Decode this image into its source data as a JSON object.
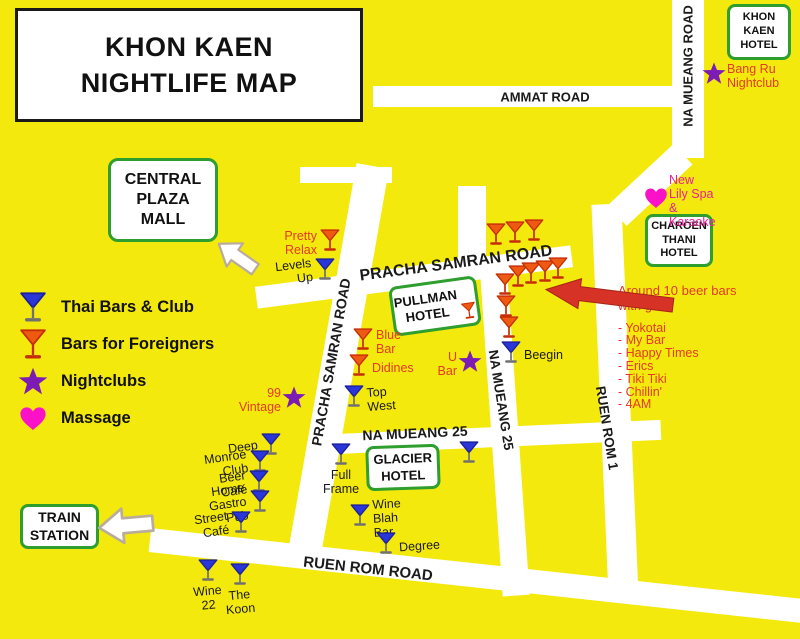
{
  "title": {
    "line1_2": "KHON KAEN\nNIGHTLIFE MAP"
  },
  "colors": {
    "background": "#F4E90C",
    "road": "#FFFFFF",
    "green_border": "#2E9E2E",
    "red_label": "#E23A26",
    "magenta_label": "#EF1D9A",
    "purple_star": "#7D1BB5",
    "blue_martini": "#2B36D9",
    "red_martini": "#EE5A11",
    "heart_pink": "#FB12C8",
    "black_text": "#1A1A1A",
    "arrow_red": "#D63226",
    "arrow_white": "#FFFFFF"
  },
  "legend": {
    "items": [
      {
        "icon": "martini-blue-icon",
        "label": "Thai Bars & Club"
      },
      {
        "icon": "martini-red-icon",
        "label": "Bars for Foreigners"
      },
      {
        "icon": "star-icon",
        "label": "Nightclubs"
      },
      {
        "icon": "heart-icon",
        "label": "Massage"
      }
    ]
  },
  "roads": [
    {
      "id": "ammat-road",
      "x": 373,
      "y": 86,
      "w": 331,
      "h": 21,
      "rot": 0
    },
    {
      "id": "na-mueang-road-upper",
      "x": 672,
      "y": 0,
      "w": 32,
      "h": 158,
      "rot": 0
    },
    {
      "id": "na-mueang-road-bend",
      "x": 636,
      "y": 140,
      "w": 28,
      "h": 90,
      "rot": 47
    },
    {
      "id": "ruen-rom-1-road",
      "x": 600,
      "y": 204,
      "w": 30,
      "h": 392,
      "rot": -2.5
    },
    {
      "id": "pracha-samran-road-horizontal",
      "x": 255,
      "y": 266,
      "w": 318,
      "h": 22,
      "rot": -7.5
    },
    {
      "id": "pracha-samran-road-vertical",
      "x": 321.5,
      "y": 162.5,
      "w": 33,
      "h": 395,
      "rot": 10
    },
    {
      "id": "pracha-samran-top-stub",
      "x": 300,
      "y": 167,
      "w": 92,
      "h": 16,
      "rot": 0
    },
    {
      "id": "na-mueang-25-top-stub",
      "x": 458,
      "y": 186,
      "w": 28,
      "h": 88,
      "rot": 0
    },
    {
      "id": "na-mueang-25-road-vertical",
      "x": 490.5,
      "y": 260,
      "w": 27,
      "h": 336,
      "rot": -4
    },
    {
      "id": "na-mueang-25-road-horizontal",
      "x": 333,
      "y": 427,
      "w": 328,
      "h": 20,
      "rot": -2.5
    },
    {
      "id": "ruen-rom-road",
      "x": 147.5,
      "y": 564,
      "w": 665,
      "h": 24,
      "rot": 6.2
    }
  ],
  "road_labels": [
    {
      "text": "AMMAT ROAD",
      "x": 545,
      "y": 97,
      "rot": 0,
      "size": 13
    },
    {
      "text": "NA MUEANG ROAD",
      "x": 688,
      "y": 66,
      "rot": -90,
      "size": 13
    },
    {
      "text": "PRACHA SAMRAN ROAD",
      "x": 456,
      "y": 264,
      "rot": -7.5,
      "size": 16
    },
    {
      "text": "PRACHA SAMRAN ROAD",
      "x": 331,
      "y": 362,
      "rot": -80,
      "size": 14
    },
    {
      "text": "NA MUEANG 25",
      "x": 415,
      "y": 433,
      "rot": -2.5,
      "size": 14
    },
    {
      "text": "NA MUEANG 25",
      "x": 501,
      "y": 400,
      "rot": 81,
      "size": 13.5
    },
    {
      "text": "RUEN ROM 1",
      "x": 607,
      "y": 428,
      "rot": 81,
      "size": 13.5
    },
    {
      "text": "RUEN ROM ROAD",
      "x": 368,
      "y": 569,
      "rot": 6.2,
      "size": 15
    }
  ],
  "places": [
    {
      "id": "khon-kaen-hotel",
      "label": "KHON\nKAEN\nHOTEL",
      "x": 727,
      "y": 4,
      "w": 64,
      "h": 56,
      "size": 11,
      "rot": 0
    },
    {
      "id": "central-plaza-mall",
      "label": "CENTRAL\nPLAZA\nMALL",
      "x": 108,
      "y": 158,
      "w": 110,
      "h": 84,
      "size": 16,
      "rot": 0
    },
    {
      "id": "charoen-thani-hotel",
      "label": "CHAROEN\nTHANI\nHOTEL",
      "x": 645,
      "y": 214,
      "w": 68,
      "h": 53,
      "size": 11,
      "rot": 0
    },
    {
      "id": "pullman-hotel",
      "label": "PULLMAN\nHOTEL",
      "x": 391,
      "y": 281,
      "w": 88,
      "h": 50,
      "size": 13,
      "rot": -8,
      "martini": true
    },
    {
      "id": "glacier-hotel",
      "label": "GLACIER\nHOTEL",
      "x": 366,
      "y": 445,
      "w": 74,
      "h": 45,
      "size": 13,
      "rot": -2
    },
    {
      "id": "train-station",
      "label": "TRAIN\nSTATION",
      "x": 20,
      "y": 504,
      "w": 79,
      "h": 45,
      "size": 14,
      "rot": 0
    }
  ],
  "markers": [
    {
      "type": "martini-red",
      "x": 330,
      "y": 243,
      "label": "Pretty\nRelax",
      "side": "left",
      "color": "red",
      "tilt": 0
    },
    {
      "type": "martini-blue",
      "x": 325,
      "y": 272,
      "label": "Levels Up",
      "side": "left",
      "color": "black",
      "tilt": -7
    },
    {
      "type": "star",
      "x": 714,
      "y": 76,
      "label": "Bang Ru\nNightclub",
      "side": "right",
      "color": "red",
      "tilt": 0
    },
    {
      "type": "heart",
      "x": 656,
      "y": 201,
      "label": "New Lily Spa &\nKaraoke",
      "side": "right",
      "color": "magenta",
      "tilt": 0
    },
    {
      "type": "martini-red",
      "x": 363,
      "y": 342,
      "label": "Blue\nBar",
      "side": "right",
      "color": "red",
      "tilt": 0
    },
    {
      "type": "martini-red",
      "x": 359,
      "y": 368,
      "label": "Didines",
      "side": "right",
      "color": "red",
      "tilt": 0
    },
    {
      "type": "star",
      "x": 470,
      "y": 364,
      "label": "U Bar",
      "side": "left",
      "color": "red",
      "tilt": 0
    },
    {
      "type": "martini-blue",
      "x": 354,
      "y": 399,
      "label": "Top West",
      "side": "right",
      "color": "black",
      "tilt": -4
    },
    {
      "type": "star",
      "x": 294,
      "y": 400,
      "label": "99\nVintage",
      "side": "left",
      "color": "red",
      "tilt": 0
    },
    {
      "type": "martini-blue",
      "x": 511,
      "y": 355,
      "label": "Beegin",
      "side": "right",
      "color": "black",
      "tilt": 0
    },
    {
      "type": "martini-red",
      "x": 496,
      "y": 237,
      "label": "",
      "side": "none",
      "color": "red",
      "tilt": 0
    },
    {
      "type": "martini-red",
      "x": 515,
      "y": 235,
      "label": "",
      "side": "none",
      "color": "red",
      "tilt": 0
    },
    {
      "type": "martini-red",
      "x": 534,
      "y": 233,
      "label": "",
      "side": "none",
      "color": "red",
      "tilt": 0
    },
    {
      "type": "martini-red",
      "x": 505,
      "y": 287,
      "label": "",
      "side": "none",
      "color": "red",
      "tilt": 0
    },
    {
      "type": "martini-red",
      "x": 518,
      "y": 279,
      "label": "",
      "side": "none",
      "color": "red",
      "tilt": 0
    },
    {
      "type": "martini-red",
      "x": 531,
      "y": 276,
      "label": "",
      "side": "none",
      "color": "red",
      "tilt": 0
    },
    {
      "type": "martini-red",
      "x": 545,
      "y": 274,
      "label": "",
      "side": "none",
      "color": "red",
      "tilt": 0
    },
    {
      "type": "martini-red",
      "x": 558,
      "y": 271,
      "label": "",
      "side": "none",
      "color": "red",
      "tilt": 0
    },
    {
      "type": "martini-red",
      "x": 506,
      "y": 309,
      "label": "",
      "side": "none",
      "color": "red",
      "tilt": 0
    },
    {
      "type": "martini-red",
      "x": 509,
      "y": 330,
      "label": "",
      "side": "none",
      "color": "red",
      "tilt": 0
    },
    {
      "type": "martini-blue",
      "x": 271,
      "y": 447,
      "label": "Deep",
      "side": "left",
      "color": "black",
      "tilt": -8
    },
    {
      "type": "martini-blue",
      "x": 260,
      "y": 464,
      "label": "Monroe Club",
      "side": "left",
      "color": "black",
      "tilt": -8
    },
    {
      "type": "martini-blue",
      "x": 259,
      "y": 484,
      "label": "Beer Café",
      "side": "left",
      "color": "black",
      "tilt": -8
    },
    {
      "type": "martini-blue",
      "x": 260,
      "y": 504,
      "label": "Home Gastro Pub",
      "side": "left",
      "color": "black",
      "tilt": -8
    },
    {
      "type": "martini-blue",
      "x": 241,
      "y": 525,
      "label": "Street\nCafé",
      "side": "left",
      "color": "black",
      "tilt": -8
    },
    {
      "type": "martini-blue",
      "x": 341,
      "y": 457,
      "label": "Full\nFrame",
      "side": "below",
      "color": "black",
      "tilt": 0
    },
    {
      "type": "martini-blue",
      "x": 469,
      "y": 455,
      "label": "",
      "side": "none",
      "color": "black",
      "tilt": 0
    },
    {
      "type": "martini-blue",
      "x": 360,
      "y": 518,
      "label": "Wine Blah Bar",
      "side": "right",
      "color": "black",
      "tilt": -3
    },
    {
      "type": "martini-blue",
      "x": 386,
      "y": 546,
      "label": "Degree",
      "side": "right",
      "color": "black",
      "tilt": -4
    },
    {
      "type": "martini-blue",
      "x": 208,
      "y": 573,
      "label": "Wine 22",
      "side": "below",
      "color": "black",
      "tilt": -5
    },
    {
      "type": "martini-blue",
      "x": 240,
      "y": 577,
      "label": "The Koon",
      "side": "below",
      "color": "black",
      "tilt": -5
    }
  ],
  "beer_bars_note": {
    "heading": "Around 10 beer bars\nwith girls:",
    "items": [
      "- Yokotai",
      "- My Bar",
      "- Happy Times",
      "- Erics",
      "- Tiki Tiki",
      "- Chillin'",
      "- 4AM"
    ]
  },
  "arrows": [
    {
      "id": "central-plaza-arrow",
      "style": "white",
      "points_to": "CENTRAL PLAZA MALL"
    },
    {
      "id": "train-station-arrow",
      "style": "white",
      "points_to": "TRAIN STATION"
    },
    {
      "id": "beer-bars-arrow",
      "style": "red",
      "points_to": "beer bar cluster"
    }
  ]
}
